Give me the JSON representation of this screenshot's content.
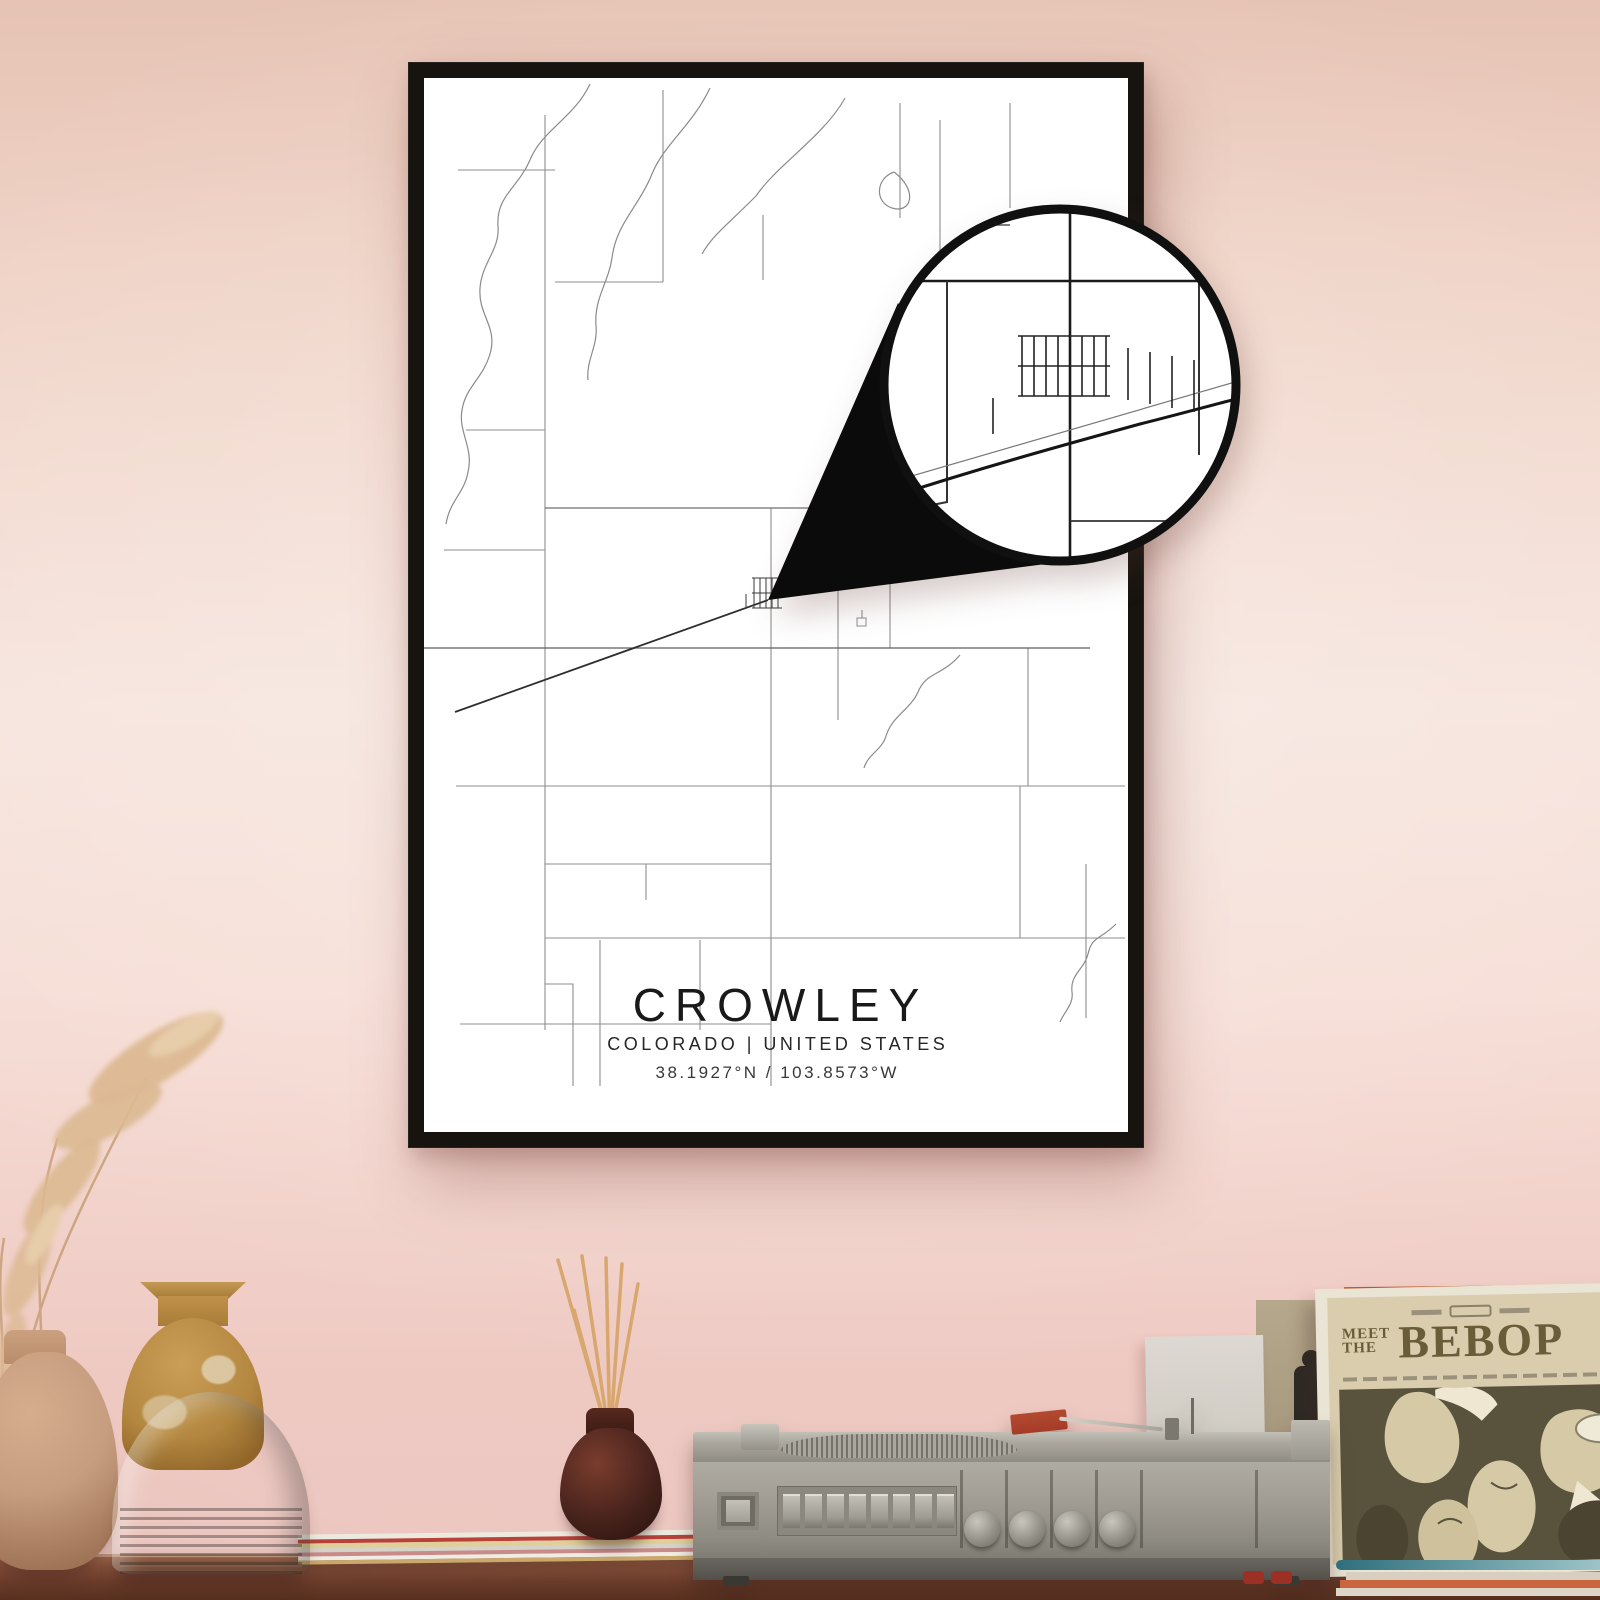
{
  "poster": {
    "title": "CROWLEY",
    "subtitle": "COLORADO | UNITED STATES",
    "coordinates": "38.1927°N / 103.8573°W"
  },
  "album": {
    "meet": "MEET",
    "the": "THE",
    "title": "BEBOP"
  },
  "colors": {
    "wall_top": "#e6c3b4",
    "wall_mid": "#f6e4dd",
    "wall_bottom": "#eec9c2",
    "frame": "#17140f",
    "poster_bg": "#ffffff",
    "road_light": "#8e8e8e",
    "road_dark": "#2e2e2e",
    "wedge": "#0b0b0b",
    "shelf": "#7c4836",
    "album_bg": "#d9cdad",
    "album_art": "#59533d",
    "album_title_color": "#6a5c39",
    "headshell_red": "#a53b28",
    "reed_stick": "#d7a76e",
    "bottle": "#45221c",
    "vase_mustard": "#b3873f",
    "vase_gray": "#b2aba1",
    "vase_tan": "#c69d7f",
    "player_body": "#a39f96"
  }
}
